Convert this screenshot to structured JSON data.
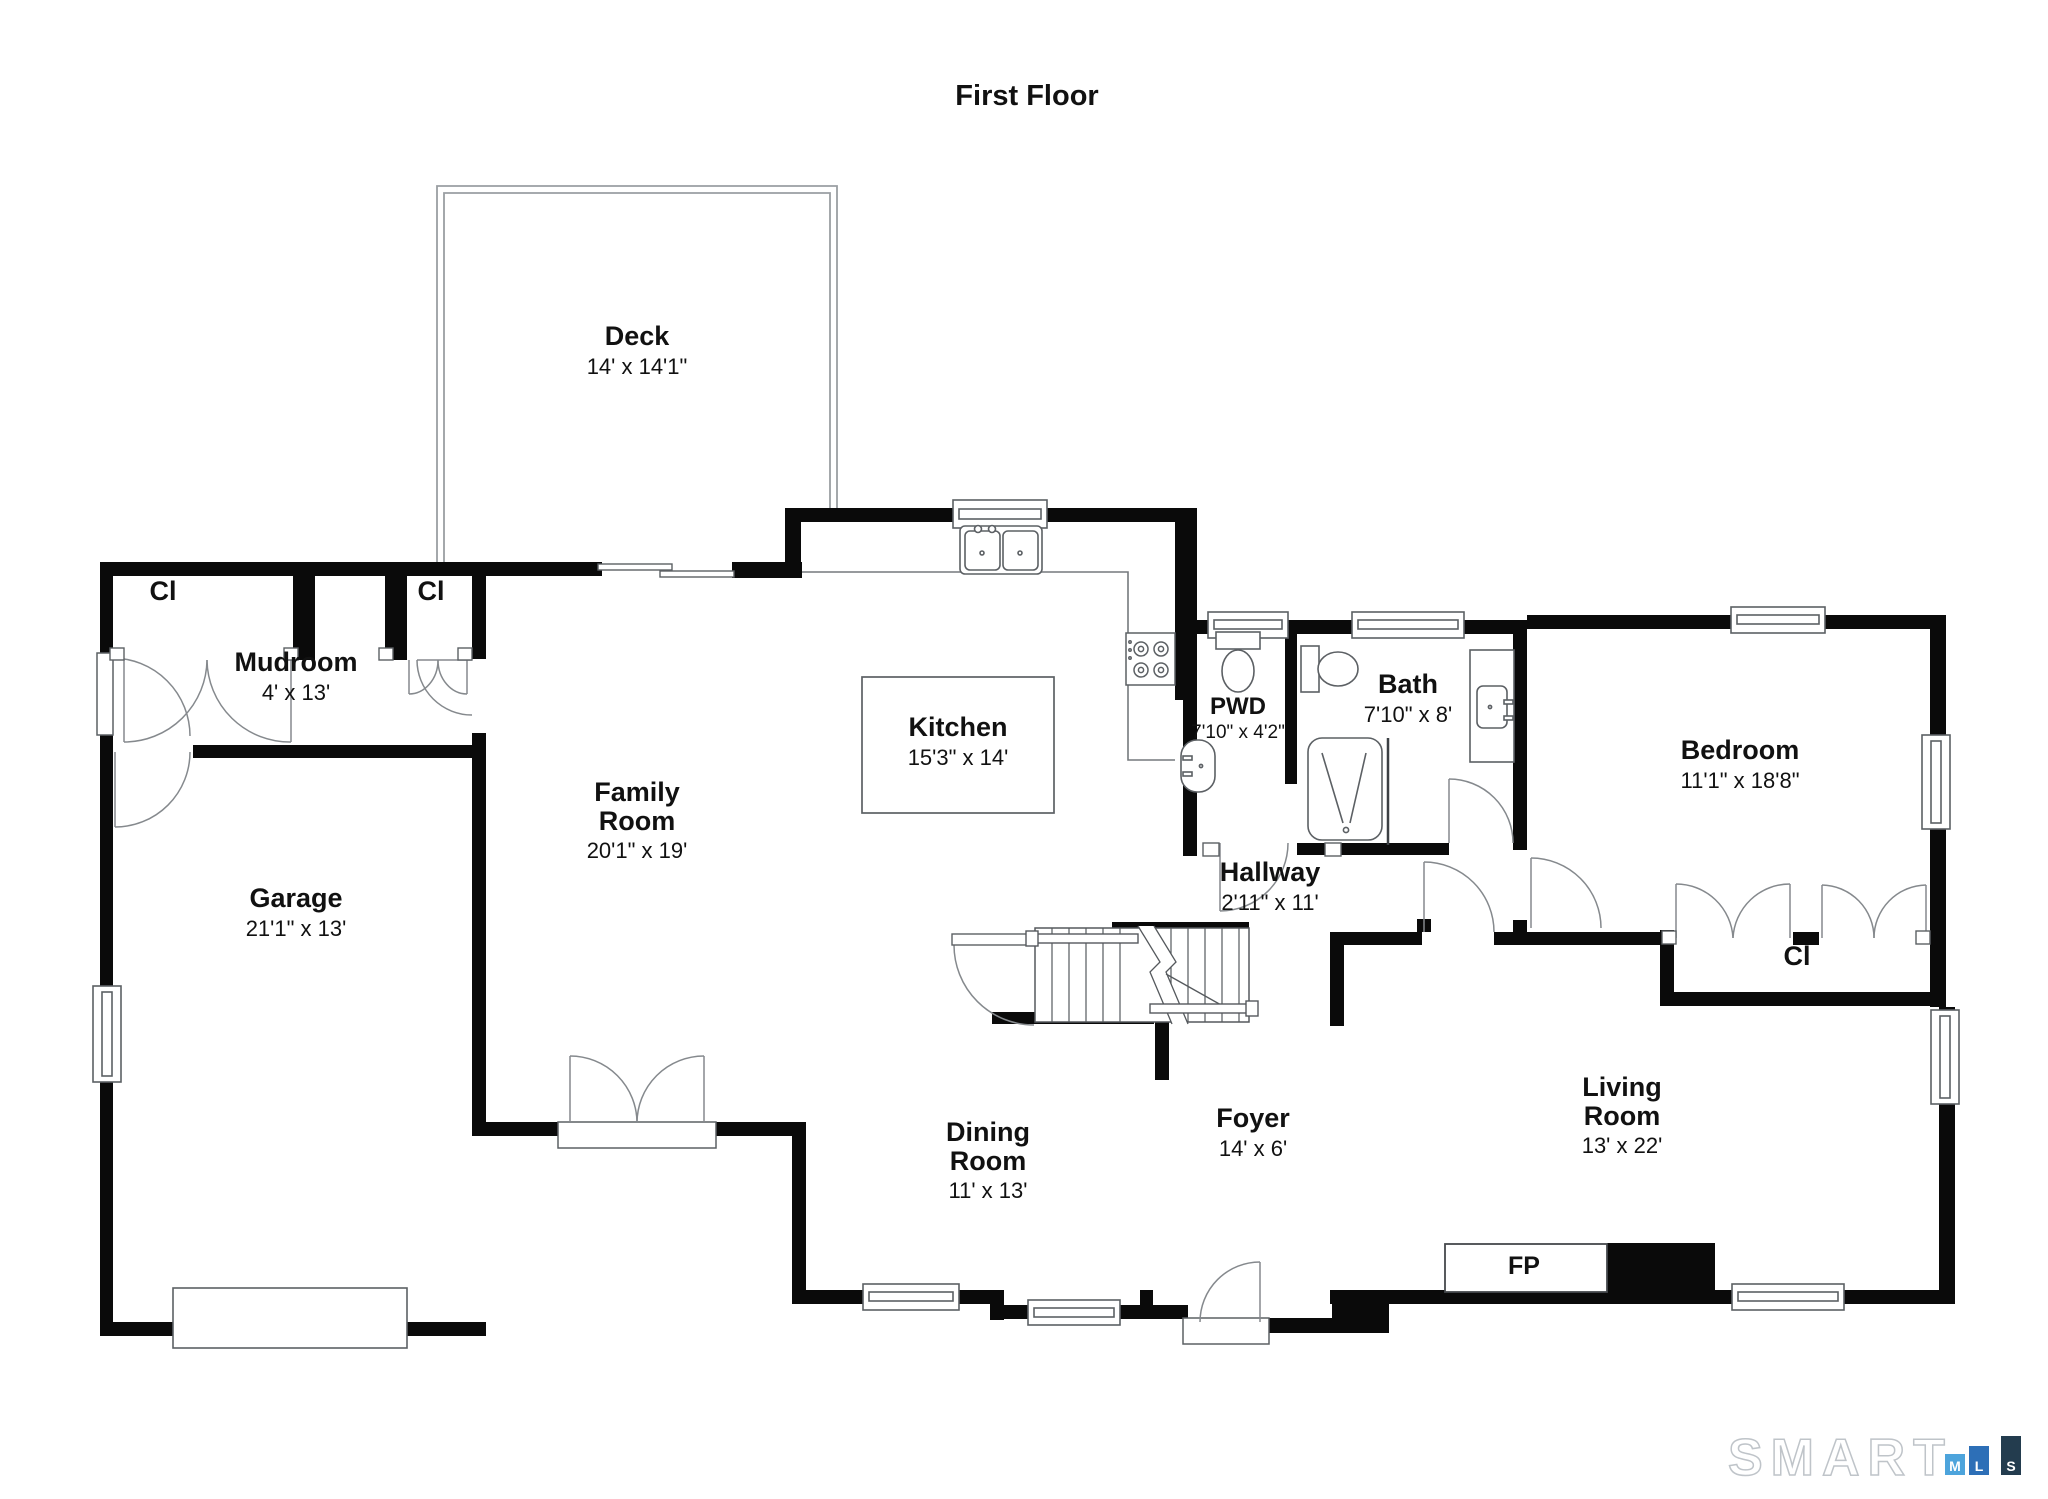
{
  "title": "First Floor",
  "rooms": {
    "deck": {
      "name": "Deck",
      "dims": "14' x 14'1\""
    },
    "mudroom": {
      "name": "Mudroom",
      "dims": "4' x 13'"
    },
    "garage": {
      "name": "Garage",
      "dims": "21'1\" x 13'"
    },
    "family_room": {
      "name": "Family Room",
      "dims": "20'1\" x 19'"
    },
    "kitchen": {
      "name": "Kitchen",
      "dims": "15'3\" x 14'"
    },
    "pwd": {
      "name": "PWD",
      "dims": "7'10\" x 4'2\""
    },
    "bath": {
      "name": "Bath",
      "dims": "7'10\" x 8'"
    },
    "bedroom": {
      "name": "Bedroom",
      "dims": "11'1\" x 18'8\""
    },
    "hallway": {
      "name": "Hallway",
      "dims": "2'11\" x 11'"
    },
    "dining_room": {
      "name": "Dining Room",
      "dims": "11' x 13'"
    },
    "foyer": {
      "name": "Foyer",
      "dims": "14' x 6'"
    },
    "living_room": {
      "name": "Living Room",
      "dims": "13' x 22'"
    }
  },
  "labels": {
    "closet": "Cl",
    "fireplace": "FP"
  },
  "logo": {
    "word": "SMART",
    "m": "M",
    "l": "L",
    "s": "S",
    "colors": {
      "m": "#4da4dc",
      "l": "#2d6fb7",
      "s": "#233c4e",
      "outline": "#bfc4c9"
    }
  }
}
